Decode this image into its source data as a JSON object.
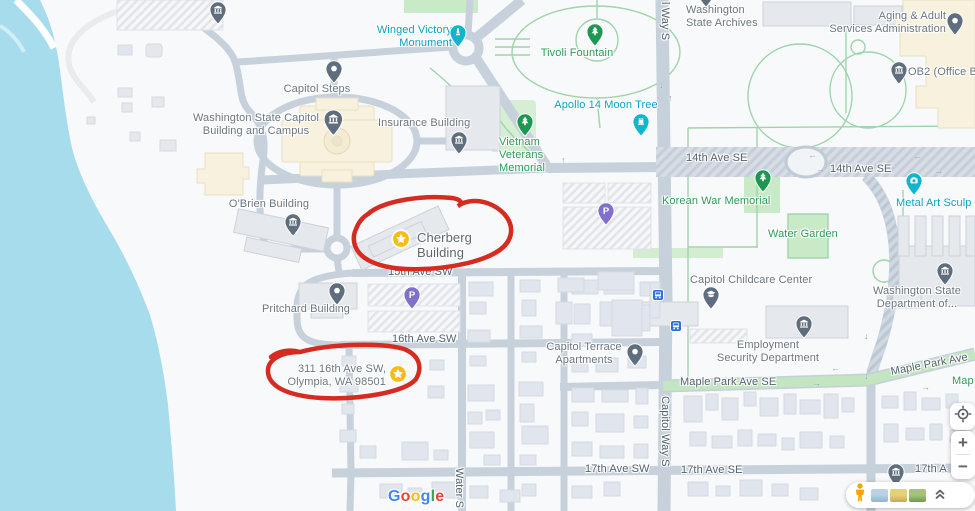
{
  "app": "map-view",
  "colors": {
    "water": "#a6dcec",
    "road": "#c7d1dc",
    "park_fill": "#c9eac7",
    "path_green": "#9fd4ac",
    "annotation_red": "#d62b20",
    "poi_label": "#6b7781",
    "street_label": "#53626f",
    "green_label": "#2f9b57",
    "teal_label": "#0aa1c2",
    "pin_gray": "#5f6e7e",
    "pin_green": "#1d9853",
    "pin_teal": "#12b5ce",
    "pin_purple": "#8070c9",
    "star_yellow": "#f9bc15",
    "transit_blue": "#2f6fe4"
  },
  "annotations": {
    "color": "#d62b20",
    "circled_items": [
      "Cherberg Building",
      "311 16th Ave SW, Olympia, WA 98501"
    ]
  },
  "map": {
    "labels": [
      {
        "name": "winged-victory-monument-label",
        "text": "Winged Victory\nMonument",
        "x": 364,
        "y": 24,
        "w": 88,
        "align": "right",
        "style": "teal"
      },
      {
        "name": "tivoli-fountain-label",
        "text": "Tivoli Fountain",
        "x": 534,
        "y": 47,
        "w": 86,
        "align": "center",
        "style": "green"
      },
      {
        "name": "washington-state-archives-label",
        "text": "Washington\nState Archives",
        "x": 686,
        "y": 4,
        "w": 90,
        "align": "left",
        "style": "poi"
      },
      {
        "name": "aging-adult-services-label",
        "text": "Aging & Adult\nServices Administration",
        "x": 806,
        "y": 10,
        "w": 140,
        "align": "right",
        "style": "poi"
      },
      {
        "name": "ob2-office-label",
        "text": "OB2 (Office B",
        "x": 908,
        "y": 66,
        "w": 80,
        "align": "left",
        "style": "poi"
      },
      {
        "name": "apollo-14-moon-tree-label",
        "text": "Apollo 14 Moon Tree",
        "x": 548,
        "y": 99,
        "w": 116,
        "align": "center",
        "style": "teal"
      },
      {
        "name": "vietnam-veterans-memorial-label",
        "text": "Vietnam\nVeterans\nMemorial",
        "x": 499,
        "y": 136,
        "w": 60,
        "align": "left",
        "style": "green"
      },
      {
        "name": "capitol-steps-label",
        "text": "Capitol Steps",
        "x": 280,
        "y": 83,
        "w": 74,
        "align": "center",
        "style": "poi"
      },
      {
        "name": "wa-state-capitol-label",
        "text": "Washington State Capitol\nBuilding and Campus",
        "x": 184,
        "y": 112,
        "w": 144,
        "align": "center",
        "style": "poi"
      },
      {
        "name": "insurance-building-label",
        "text": "Insurance Building",
        "x": 378,
        "y": 117,
        "w": 102,
        "align": "left",
        "style": "poi"
      },
      {
        "name": "14th-ave-se-label-west",
        "text": "14th Ave SE",
        "x": 686,
        "y": 152,
        "w": 66,
        "align": "left",
        "style": "street"
      },
      {
        "name": "14th-ave-se-label-east",
        "text": "14th Ave SE",
        "x": 830,
        "y": 163,
        "w": 66,
        "align": "left",
        "style": "street"
      },
      {
        "name": "korean-war-memorial-label",
        "text": "Korean War Memorial",
        "x": 662,
        "y": 195,
        "w": 122,
        "align": "left",
        "style": "green"
      },
      {
        "name": "metal-art-sculpture-label",
        "text": "Metal Art Sculp",
        "x": 896,
        "y": 197,
        "w": 86,
        "align": "left",
        "style": "teal"
      },
      {
        "name": "water-garden-label",
        "text": "Water Garden",
        "x": 768,
        "y": 228,
        "w": 78,
        "align": "left",
        "style": "green"
      },
      {
        "name": "obrien-building-label",
        "text": "O'Brien Building",
        "x": 224,
        "y": 198,
        "w": 90,
        "align": "center",
        "style": "poi"
      },
      {
        "name": "cherberg-building-label",
        "text": "Cherberg Building",
        "x": 417,
        "y": 230,
        "w": 96,
        "align": "left",
        "style": "title"
      },
      {
        "name": "15th-ave-sw-label",
        "text": "15th Ave SW",
        "x": 388,
        "y": 266,
        "w": 66,
        "align": "left",
        "style": "street"
      },
      {
        "name": "capitol-childcare-center-label",
        "text": "Capitol Childcare Center",
        "x": 690,
        "y": 274,
        "w": 134,
        "align": "left",
        "style": "poi"
      },
      {
        "name": "pritchard-building-label",
        "text": "Pritchard Building",
        "x": 262,
        "y": 303,
        "w": 98,
        "align": "left",
        "style": "poi"
      },
      {
        "name": "wa-dept-label",
        "text": "Washington State\nDepartment of...",
        "x": 868,
        "y": 285,
        "w": 98,
        "align": "center",
        "style": "poi"
      },
      {
        "name": "16th-ave-sw-label",
        "text": "16th Ave SW",
        "x": 392,
        "y": 333,
        "w": 66,
        "align": "left",
        "style": "street"
      },
      {
        "name": "capitol-terrace-apartments-label",
        "text": "Capitol Terrace\nApartments",
        "x": 541,
        "y": 341,
        "w": 86,
        "align": "center",
        "style": "poi"
      },
      {
        "name": "employment-security-label",
        "text": "Employment\nSecurity Department",
        "x": 708,
        "y": 339,
        "w": 120,
        "align": "center",
        "style": "poi"
      },
      {
        "name": "address-311-16th-ave-label",
        "text": "311 16th Ave SW,\nOlympia, WA 98501",
        "x": 280,
        "y": 363,
        "w": 106,
        "align": "right",
        "style": "poi"
      },
      {
        "name": "maple-park-ave-se-label",
        "text": "Maple Park Ave SE",
        "x": 680,
        "y": 376,
        "w": 106,
        "align": "left",
        "style": "street"
      },
      {
        "name": "maple-park-ave-rotated-label",
        "text": "Maple Park Ave",
        "x": 891,
        "y": 366,
        "w": 90,
        "align": "left",
        "style": "street",
        "rot": -11
      },
      {
        "name": "maple-green-partial-label",
        "text": "Map",
        "x": 952,
        "y": 375,
        "w": 26,
        "align": "left",
        "style": "green"
      },
      {
        "name": "capitol-way-s-top-label",
        "text": "l Way S",
        "x": 658,
        "y": 2,
        "vert": true,
        "style": "street"
      },
      {
        "name": "capitol-way-s-label",
        "text": "Capitol Way S",
        "x": 658,
        "y": 396,
        "vert": true,
        "style": "street"
      },
      {
        "name": "water-st-label",
        "text": "Water S",
        "x": 452,
        "y": 468,
        "vert": true,
        "style": "street"
      },
      {
        "name": "17th-ave-sw-label",
        "text": "17th Ave SW",
        "x": 585,
        "y": 463,
        "w": 70,
        "align": "left",
        "style": "street"
      },
      {
        "name": "17th-ave-se-label",
        "text": "17th Ave SE",
        "x": 681,
        "y": 464,
        "w": 68,
        "align": "left",
        "style": "street"
      },
      {
        "name": "17th-ave-partial-label",
        "text": "17th A",
        "x": 915,
        "y": 463,
        "w": 42,
        "align": "left",
        "style": "street"
      }
    ],
    "pins": [
      {
        "name": "museum-pin-top-left",
        "type": "museum",
        "x": 209,
        "y": 1
      },
      {
        "name": "archives-pin-partial",
        "type": "museum",
        "x": 697,
        "y": -16
      },
      {
        "name": "capitol-steps-pin",
        "type": "dot",
        "x": 325,
        "y": 60
      },
      {
        "name": "wa-capitol-pin",
        "type": "museum",
        "x": 323,
        "y": 109,
        "s": 1.15
      },
      {
        "name": "insurance-building-pin",
        "type": "museum",
        "x": 450,
        "y": 131
      },
      {
        "name": "winged-victory-pin",
        "type": "monument",
        "x": 449,
        "y": 24
      },
      {
        "name": "tivoli-fountain-pin",
        "type": "tree",
        "x": 586,
        "y": 23
      },
      {
        "name": "vietnam-veterans-pin",
        "type": "tree",
        "x": 516,
        "y": 113
      },
      {
        "name": "apollo-moon-tree-pin",
        "type": "rook",
        "x": 632,
        "y": 113
      },
      {
        "name": "aging-adult-pin",
        "type": "dot",
        "x": 946,
        "y": 12
      },
      {
        "name": "ob2-pin",
        "type": "museum",
        "x": 890,
        "y": 61
      },
      {
        "name": "korean-war-memorial-pin",
        "type": "tree",
        "x": 754,
        "y": 169
      },
      {
        "name": "metal-art-sculpture-pin",
        "type": "camera",
        "x": 905,
        "y": 172
      },
      {
        "name": "parking-pin-north",
        "type": "parking",
        "x": 597,
        "y": 202
      },
      {
        "name": "obrien-building-pin",
        "type": "museum",
        "x": 284,
        "y": 213
      },
      {
        "name": "cherberg-star-pin",
        "type": "star",
        "x": 391,
        "y": 229
      },
      {
        "name": "pritchard-building-pin",
        "type": "dot",
        "x": 328,
        "y": 282
      },
      {
        "name": "parking-pin-south",
        "type": "parking",
        "x": 403,
        "y": 286
      },
      {
        "name": "childcare-pin",
        "type": "grad",
        "x": 702,
        "y": 286
      },
      {
        "name": "employment-security-pin",
        "type": "museum",
        "x": 795,
        "y": 315
      },
      {
        "name": "wa-dept-pin",
        "type": "museum",
        "x": 936,
        "y": 262
      },
      {
        "name": "capitol-terrace-pin",
        "type": "dot",
        "x": 626,
        "y": 343
      },
      {
        "name": "address-star-pin",
        "type": "star",
        "x": 388,
        "y": 364
      },
      {
        "name": "bus-stop-north",
        "type": "bus",
        "x": 652,
        "y": 288
      },
      {
        "name": "bus-stop-south",
        "type": "bus",
        "x": 670,
        "y": 319
      },
      {
        "name": "museum-pin-17th",
        "type": "museum",
        "x": 887,
        "y": 463
      }
    ],
    "road_arrows": [
      {
        "g": "←",
        "x": 808,
        "y": 150
      },
      {
        "g": "←",
        "x": 913,
        "y": 151
      },
      {
        "g": "→",
        "x": 816,
        "y": 164
      },
      {
        "g": "→",
        "x": 934,
        "y": 166
      },
      {
        "g": "↓",
        "x": 659,
        "y": 80
      },
      {
        "g": "↑",
        "x": 668,
        "y": 93
      },
      {
        "g": "↑",
        "x": 561,
        "y": 155
      },
      {
        "g": "←",
        "x": 831,
        "y": 363
      },
      {
        "g": "→",
        "x": 812,
        "y": 378
      },
      {
        "g": "↓",
        "x": 864,
        "y": 331
      },
      {
        "g": "↓",
        "x": 864,
        "y": 371
      },
      {
        "g": "→",
        "x": 921,
        "y": 382
      }
    ]
  },
  "logo": {
    "letters": [
      {
        "c": "G",
        "color": "#4285F4"
      },
      {
        "c": "o",
        "color": "#EA4335"
      },
      {
        "c": "o",
        "color": "#FBBC05"
      },
      {
        "c": "g",
        "color": "#4285F4"
      },
      {
        "c": "l",
        "color": "#34A853"
      },
      {
        "c": "e",
        "color": "#EA4335"
      }
    ]
  },
  "controls": {
    "zoom_in": "+",
    "zoom_out": "−",
    "icons": {
      "my_location": "crosshair-target",
      "pegman": "orange-person",
      "collapse": "double-chevron-up",
      "layer_thumbnails": [
        "coast-photo",
        "terrain-photo",
        "field-photo"
      ]
    }
  }
}
